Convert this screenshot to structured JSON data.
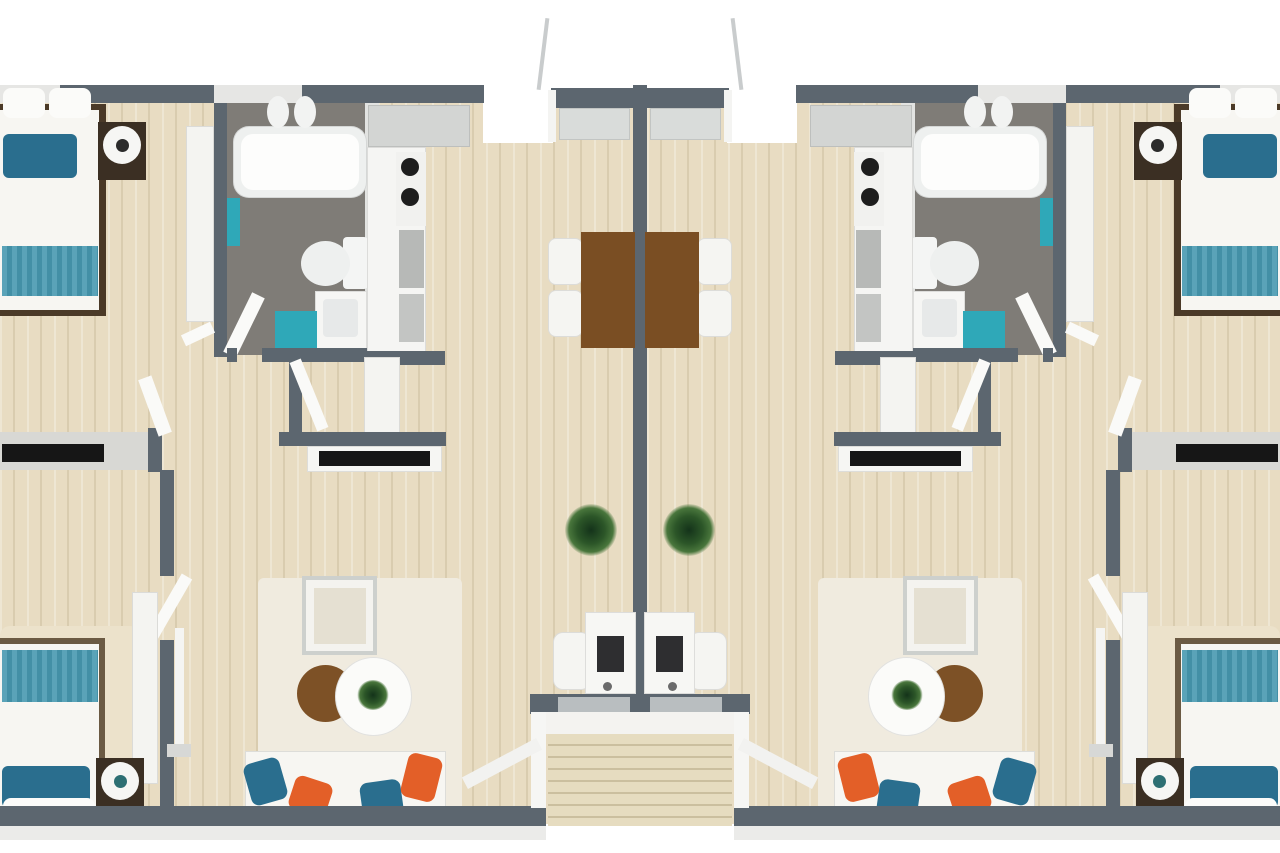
{
  "floorplan": {
    "kind": "duplex-3d-floor-plan",
    "units": [
      "left-unit",
      "right-unit"
    ],
    "rooms": [
      "bedroom-top",
      "bathroom",
      "kitchen",
      "closet",
      "living-dining",
      "bedroom-bottom",
      "rear-porch",
      "front-entry-stairs"
    ],
    "palette": {
      "wall": "#5c666f",
      "wood_floor": "#e8dcc2",
      "bath_floor": "#7f7c77",
      "white_furniture": "#f7f6f2",
      "light_gray": "#d8d9d7",
      "teal": "#2fa8b8",
      "teal_dark": "#2a6e8e",
      "teal_bedding": "#4e9ab0",
      "orange": "#e35f28",
      "table_brown": "#7a4e23",
      "dark_wood": "#3b2f23",
      "plant_green": "#2c5628",
      "tv_black": "#161616"
    }
  },
  "scene": {
    "canvas": {
      "width": 1280,
      "height": 853
    },
    "items": [
      {
        "n": "unit-floor",
        "cls": "wood",
        "x": 0,
        "y": 100,
        "w": 633,
        "h": 724,
        "m": true
      },
      {
        "n": "rear-notch",
        "x": 483,
        "y": 85,
        "w": 70,
        "h": 58,
        "c": "#ffffff",
        "m": true
      },
      {
        "n": "top-window-bedroom",
        "x": 0,
        "y": 85,
        "w": 62,
        "h": 18,
        "c": "#e6e6e4",
        "m": true
      },
      {
        "n": "top-wall-bedroom",
        "cls": "wall",
        "x": 60,
        "y": 85,
        "w": 156,
        "h": 18,
        "m": true
      },
      {
        "n": "top-window-bath",
        "x": 214,
        "y": 85,
        "w": 90,
        "h": 18,
        "c": "#e6e6e4",
        "m": true
      },
      {
        "n": "top-wall-kitchen",
        "cls": "wall",
        "x": 302,
        "y": 85,
        "w": 182,
        "h": 18,
        "m": true
      },
      {
        "n": "rear-porch-rail",
        "x": 541,
        "y": 18,
        "w": 4,
        "h": 72,
        "c": "#c9cccd",
        "rot": 7,
        "m": true
      },
      {
        "n": "rear-porch-wall",
        "cls": "wall",
        "x": 551,
        "y": 88,
        "w": 89,
        "h": 20,
        "m": true
      },
      {
        "n": "rear-porch-post",
        "x": 548,
        "y": 90,
        "w": 8,
        "h": 52,
        "c": "#f4f4f2",
        "m": true
      },
      {
        "n": "rear-door",
        "cls": "soft",
        "x": 559,
        "y": 108,
        "w": 71,
        "h": 32,
        "c": "#d9dcda",
        "m": true
      },
      {
        "n": "center-party-wall",
        "cls": "wall",
        "x": 633,
        "y": 85,
        "w": 14,
        "h": 622
      },
      {
        "n": "bed-top-frame",
        "x": 0,
        "y": 104,
        "w": 106,
        "h": 212,
        "c": "#4b3a28",
        "m": true
      },
      {
        "n": "bed-top-mattress",
        "x": 0,
        "y": 110,
        "w": 99,
        "h": 200,
        "c": "#f7f6f2",
        "m": true
      },
      {
        "n": "bed-top-pillow-a",
        "x": 3,
        "y": 88,
        "w": 42,
        "h": 30,
        "c": "#fbfbf9",
        "r": "8px",
        "m": true
      },
      {
        "n": "bed-top-pillow-b",
        "x": 49,
        "y": 88,
        "w": 42,
        "h": 30,
        "c": "#fbfbf9",
        "r": "8px",
        "m": true
      },
      {
        "n": "bed-top-cushions",
        "x": 3,
        "y": 134,
        "w": 74,
        "h": 44,
        "c": "#2a6e8e",
        "r": "6px",
        "m": true
      },
      {
        "n": "bed-top-blanket",
        "cls": "stripes",
        "x": 2,
        "y": 246,
        "w": 96,
        "h": 50,
        "m": true
      },
      {
        "n": "nightstand-top",
        "x": 98,
        "y": 122,
        "w": 48,
        "h": 58,
        "c": "#3b2f23",
        "m": true
      },
      {
        "n": "lamp-top-shade",
        "x": 103,
        "y": 126,
        "w": 38,
        "h": 38,
        "c": "#f6f6f4",
        "r": "50%",
        "m": true
      },
      {
        "n": "lamp-top-center",
        "x": 116,
        "y": 139,
        "w": 13,
        "h": 13,
        "c": "#2b2b2b",
        "r": "50%",
        "m": true
      },
      {
        "n": "closet-bedroom-top",
        "cls": "soft",
        "x": 186,
        "y": 126,
        "w": 28,
        "h": 196,
        "c": "#f4f4f1",
        "m": true
      },
      {
        "n": "wall-bedroom-bath",
        "cls": "wall",
        "x": 214,
        "y": 103,
        "w": 13,
        "h": 254,
        "m": true
      },
      {
        "n": "door-bedroom-top",
        "x": 182,
        "y": 328,
        "w": 32,
        "h": 12,
        "c": "#fafaf8",
        "rot": -25,
        "m": true
      },
      {
        "n": "bathroom-floor",
        "x": 227,
        "y": 103,
        "w": 140,
        "h": 252,
        "c": "#7f7c77",
        "m": true
      },
      {
        "n": "bathroom-wall-kitchen",
        "x": 365,
        "y": 103,
        "w": 14,
        "h": 252,
        "c": "#e2e3e1",
        "m": true
      },
      {
        "n": "bathtub",
        "cls": "soft",
        "x": 233,
        "y": 126,
        "w": 134,
        "h": 72,
        "c": "#eef0ef",
        "r": "16px",
        "m": true
      },
      {
        "n": "bathtub-basin",
        "x": 241,
        "y": 134,
        "w": 118,
        "h": 56,
        "c": "#fdfdfc",
        "r": "12px",
        "m": true
      },
      {
        "n": "bath-faucet-a",
        "x": 267,
        "y": 96,
        "w": 22,
        "h": 32,
        "c": "#f2f3f2",
        "r": "50%",
        "m": true
      },
      {
        "n": "bath-faucet-b",
        "x": 294,
        "y": 96,
        "w": 22,
        "h": 32,
        "c": "#f2f3f2",
        "r": "50%",
        "m": true
      },
      {
        "n": "towel-rack",
        "x": 227,
        "y": 198,
        "w": 13,
        "h": 48,
        "c": "#2fa8b8",
        "m": true
      },
      {
        "n": "toilet-tank",
        "x": 343,
        "y": 237,
        "w": 25,
        "h": 52,
        "c": "#f4f5f4",
        "r": "4px",
        "m": true
      },
      {
        "n": "toilet-bowl",
        "x": 301,
        "y": 241,
        "w": 49,
        "h": 45,
        "c": "#eef0ef",
        "r": "50%",
        "m": true
      },
      {
        "n": "vanity",
        "cls": "soft",
        "x": 315,
        "y": 291,
        "w": 52,
        "h": 58,
        "c": "#f6f6f4",
        "m": true
      },
      {
        "n": "sink-basin",
        "x": 323,
        "y": 299,
        "w": 35,
        "h": 38,
        "c": "#e7e9e9",
        "r": "4px",
        "m": true
      },
      {
        "n": "bath-mat",
        "x": 275,
        "y": 311,
        "w": 42,
        "h": 40,
        "c": "#2fa8b8",
        "m": true
      },
      {
        "n": "door-bathroom",
        "x": 237,
        "y": 292,
        "w": 14,
        "h": 66,
        "c": "#fafaf8",
        "rot": 26,
        "m": true
      },
      {
        "n": "bath-wall-bottom",
        "cls": "wall",
        "x": 262,
        "y": 348,
        "w": 118,
        "h": 14,
        "m": true
      },
      {
        "n": "bath-wall-stub",
        "cls": "wall",
        "x": 227,
        "y": 348,
        "w": 10,
        "h": 14,
        "m": true
      },
      {
        "n": "kitchen-upper-cabinets",
        "cls": "soft",
        "x": 368,
        "y": 105,
        "w": 102,
        "h": 42,
        "c": "#d3d5d3",
        "m": true
      },
      {
        "n": "kitchen-counter",
        "cls": "soft",
        "x": 367,
        "y": 147,
        "w": 59,
        "h": 208,
        "c": "#f5f5f3",
        "m": true
      },
      {
        "n": "stove",
        "x": 396,
        "y": 152,
        "w": 30,
        "h": 74,
        "c": "#f1f1ef",
        "m": true
      },
      {
        "n": "stove-burner-a",
        "x": 401,
        "y": 158,
        "w": 18,
        "h": 18,
        "c": "#1d1d1d",
        "r": "50%",
        "m": true
      },
      {
        "n": "stove-burner-b",
        "x": 401,
        "y": 188,
        "w": 18,
        "h": 18,
        "c": "#1d1d1d",
        "r": "50%",
        "m": true
      },
      {
        "n": "kitchen-sink-unit",
        "cls": "ridged",
        "x": 399,
        "y": 230,
        "w": 25,
        "h": 58,
        "c": "#b7b9b7",
        "m": true
      },
      {
        "n": "kitchen-appliance",
        "cls": "ridged",
        "x": 399,
        "y": 294,
        "w": 25,
        "h": 48,
        "c": "#c3c5c3",
        "m": true
      },
      {
        "n": "kitchen-wall-bottom",
        "cls": "wall",
        "x": 367,
        "y": 351,
        "w": 78,
        "h": 14,
        "m": true
      },
      {
        "n": "closet-wall",
        "cls": "wall",
        "x": 289,
        "y": 352,
        "w": 13,
        "h": 94,
        "m": true
      },
      {
        "n": "door-closet",
        "x": 303,
        "y": 358,
        "w": 12,
        "h": 74,
        "c": "#fafaf8",
        "rot": -22,
        "m": true
      },
      {
        "n": "closet-storage",
        "cls": "soft",
        "x": 364,
        "y": 357,
        "w": 36,
        "h": 76,
        "c": "#f4f4f1",
        "m": true
      },
      {
        "n": "hall-wall",
        "cls": "wall",
        "x": 279,
        "y": 432,
        "w": 167,
        "h": 14,
        "m": true
      },
      {
        "n": "media-console",
        "cls": "soft",
        "x": 307,
        "y": 446,
        "w": 135,
        "h": 26,
        "c": "#f6f6f3",
        "m": true
      },
      {
        "n": "tv-living",
        "x": 319,
        "y": 451,
        "w": 111,
        "h": 15,
        "c": "#161616",
        "m": true
      },
      {
        "n": "bedroom-divider",
        "x": 0,
        "y": 432,
        "w": 150,
        "h": 38,
        "c": "#d8d8d4",
        "m": true
      },
      {
        "n": "tv-bedroom",
        "x": 2,
        "y": 444,
        "w": 102,
        "h": 18,
        "c": "#161616",
        "m": true
      },
      {
        "n": "divider-stub",
        "cls": "wall",
        "x": 148,
        "y": 428,
        "w": 14,
        "h": 44,
        "m": true
      },
      {
        "n": "door-bedroom-bottom-entry",
        "x": 148,
        "y": 376,
        "w": 14,
        "h": 60,
        "c": "#fafaf8",
        "rot": -20,
        "m": true
      },
      {
        "n": "bedroom-bottom-wall-a",
        "cls": "wall",
        "x": 160,
        "y": 470,
        "w": 14,
        "h": 106,
        "m": true
      },
      {
        "n": "bedroom-bottom-wall-b",
        "cls": "wall",
        "x": 160,
        "y": 640,
        "w": 14,
        "h": 184,
        "m": true
      },
      {
        "n": "door-bedroom-bottom",
        "x": 164,
        "y": 572,
        "w": 12,
        "h": 68,
        "c": "#fafaf8",
        "rot": 30,
        "m": true
      },
      {
        "n": "bedroom-bottom-rug",
        "x": 0,
        "y": 626,
        "w": 140,
        "h": 198,
        "c": "#ece2cb",
        "r": "10px",
        "m": true
      },
      {
        "n": "closet-bedroom-bottom",
        "cls": "soft",
        "x": 132,
        "y": 592,
        "w": 26,
        "h": 192,
        "c": "#f4f4f1",
        "m": true
      },
      {
        "n": "floor-lamp-pole",
        "x": 175,
        "y": 628,
        "w": 9,
        "h": 120,
        "c": "#f5f5f3",
        "m": true
      },
      {
        "n": "floor-lamp-base",
        "x": 167,
        "y": 744,
        "w": 24,
        "h": 13,
        "c": "#d7d8d6",
        "m": true
      },
      {
        "n": "bed-bottom-frame",
        "x": 0,
        "y": 638,
        "w": 105,
        "h": 194,
        "c": "#6b5a43",
        "m": true
      },
      {
        "n": "bed-bottom-mattress",
        "x": 0,
        "y": 644,
        "w": 99,
        "h": 188,
        "c": "#f7f6f2",
        "m": true
      },
      {
        "n": "bed-bottom-blanket",
        "cls": "stripes",
        "x": 2,
        "y": 650,
        "w": 96,
        "h": 52,
        "m": true
      },
      {
        "n": "bed-bottom-cushions",
        "x": 2,
        "y": 766,
        "w": 88,
        "h": 42,
        "c": "#2a6e8e",
        "r": "6px",
        "m": true
      },
      {
        "n": "bed-bottom-pillows",
        "x": 3,
        "y": 798,
        "w": 92,
        "h": 30,
        "c": "#fbfbf9",
        "r": "8px",
        "m": true
      },
      {
        "n": "nightstand-bottom",
        "x": 96,
        "y": 758,
        "w": 48,
        "h": 58,
        "c": "#3b2f23",
        "m": true
      },
      {
        "n": "lamp-bottom-shade",
        "x": 101,
        "y": 762,
        "w": 38,
        "h": 38,
        "c": "#f6f6f4",
        "r": "50%",
        "m": true
      },
      {
        "n": "lamp-bottom-center",
        "x": 114,
        "y": 775,
        "w": 13,
        "h": 13,
        "c": "#2d6f73",
        "r": "50%",
        "m": true
      },
      {
        "n": "dining-chair-a",
        "cls": "soft",
        "x": 548,
        "y": 238,
        "w": 35,
        "h": 47,
        "c": "#f5f5f2",
        "r": "8px",
        "m": true
      },
      {
        "n": "dining-chair-b",
        "cls": "soft",
        "x": 548,
        "y": 290,
        "w": 35,
        "h": 47,
        "c": "#f5f5f2",
        "r": "8px",
        "m": true
      },
      {
        "n": "dining-table",
        "x": 581,
        "y": 232,
        "w": 54,
        "h": 116,
        "c": "#7a4e23",
        "m": true
      },
      {
        "n": "floor-plant",
        "cls": "plant",
        "x": 565,
        "y": 504,
        "w": 52,
        "h": 52,
        "m": true
      },
      {
        "n": "desk-chair",
        "cls": "soft",
        "x": 553,
        "y": 632,
        "w": 38,
        "h": 58,
        "c": "#f5f5f2",
        "r": "10px",
        "m": true
      },
      {
        "n": "desk",
        "cls": "soft",
        "x": 585,
        "y": 612,
        "w": 51,
        "h": 82,
        "c": "#f7f7f4",
        "m": true
      },
      {
        "n": "desk-monitor",
        "x": 597,
        "y": 636,
        "w": 27,
        "h": 36,
        "c": "#2e2e30",
        "m": true
      },
      {
        "n": "desk-mouse",
        "x": 603,
        "y": 682,
        "w": 9,
        "h": 9,
        "c": "#6b6b6b",
        "r": "50%",
        "m": true
      },
      {
        "n": "living-rug",
        "x": 258,
        "y": 578,
        "w": 204,
        "h": 236,
        "c": "#f0ebdf",
        "r": "6px",
        "m": true
      },
      {
        "n": "armchair",
        "x": 302,
        "y": 576,
        "w": 75,
        "h": 79,
        "c": "#f4f3ef",
        "b": "4px solid #cdd0cd",
        "m": true
      },
      {
        "n": "armchair-cushion",
        "x": 314,
        "y": 588,
        "w": 52,
        "h": 56,
        "c": "#e5e0d2",
        "m": true
      },
      {
        "n": "coffee-table-brown",
        "x": 297,
        "y": 665,
        "w": 57,
        "h": 57,
        "c": "#7d5126",
        "r": "50%",
        "m": true
      },
      {
        "n": "coffee-table-white",
        "cls": "soft",
        "x": 335,
        "y": 657,
        "w": 77,
        "h": 79,
        "c": "#fbfbf9",
        "r": "50%",
        "m": true
      },
      {
        "n": "coffee-table-plant",
        "cls": "plant",
        "x": 357,
        "y": 680,
        "w": 32,
        "h": 30,
        "m": true
      },
      {
        "n": "sofa",
        "cls": "soft",
        "x": 245,
        "y": 751,
        "w": 201,
        "h": 79,
        "c": "#f7f6f2",
        "m": true
      },
      {
        "n": "sofa-pillow-teal-a",
        "x": 247,
        "y": 760,
        "w": 37,
        "h": 43,
        "c": "#2a6e8e",
        "r": "8px",
        "rot": -16,
        "m": true
      },
      {
        "n": "sofa-pillow-orange-a",
        "x": 291,
        "y": 779,
        "w": 39,
        "h": 35,
        "c": "#e35f28",
        "r": "8px",
        "rot": 18,
        "m": true
      },
      {
        "n": "sofa-pillow-teal-b",
        "x": 361,
        "y": 781,
        "w": 41,
        "h": 35,
        "c": "#2a6e8e",
        "r": "8px",
        "rot": -8,
        "m": true
      },
      {
        "n": "sofa-pillow-orange-b",
        "x": 404,
        "y": 755,
        "w": 35,
        "h": 45,
        "c": "#e35f28",
        "r": "8px",
        "rot": 14,
        "m": true
      },
      {
        "n": "front-wall",
        "cls": "wall",
        "x": 0,
        "y": 806,
        "w": 546,
        "h": 20,
        "m": true
      },
      {
        "n": "front-facade",
        "x": 0,
        "y": 826,
        "w": 546,
        "h": 14,
        "c": "#ebebe9",
        "m": true
      },
      {
        "n": "entry-porch-wall",
        "cls": "wall",
        "x": 530,
        "y": 694,
        "w": 220,
        "h": 20
      },
      {
        "n": "front-door",
        "x": 558,
        "y": 697,
        "w": 72,
        "h": 15,
        "c": "#b9bec0",
        "m": true
      },
      {
        "n": "entry-platform",
        "x": 540,
        "y": 712,
        "w": 200,
        "h": 22,
        "c": "#f4f3f0"
      },
      {
        "n": "entry-steps",
        "cls": "stairs",
        "x": 548,
        "y": 734,
        "w": 184,
        "h": 92
      },
      {
        "n": "entry-rail-post",
        "x": 531,
        "y": 712,
        "w": 15,
        "h": 96,
        "c": "#f6f6f4",
        "m": true
      },
      {
        "n": "entry-rail-diagonal",
        "x": 460,
        "y": 757,
        "w": 84,
        "h": 13,
        "c": "#f2f2f0",
        "rot": -28,
        "m": true
      }
    ]
  }
}
